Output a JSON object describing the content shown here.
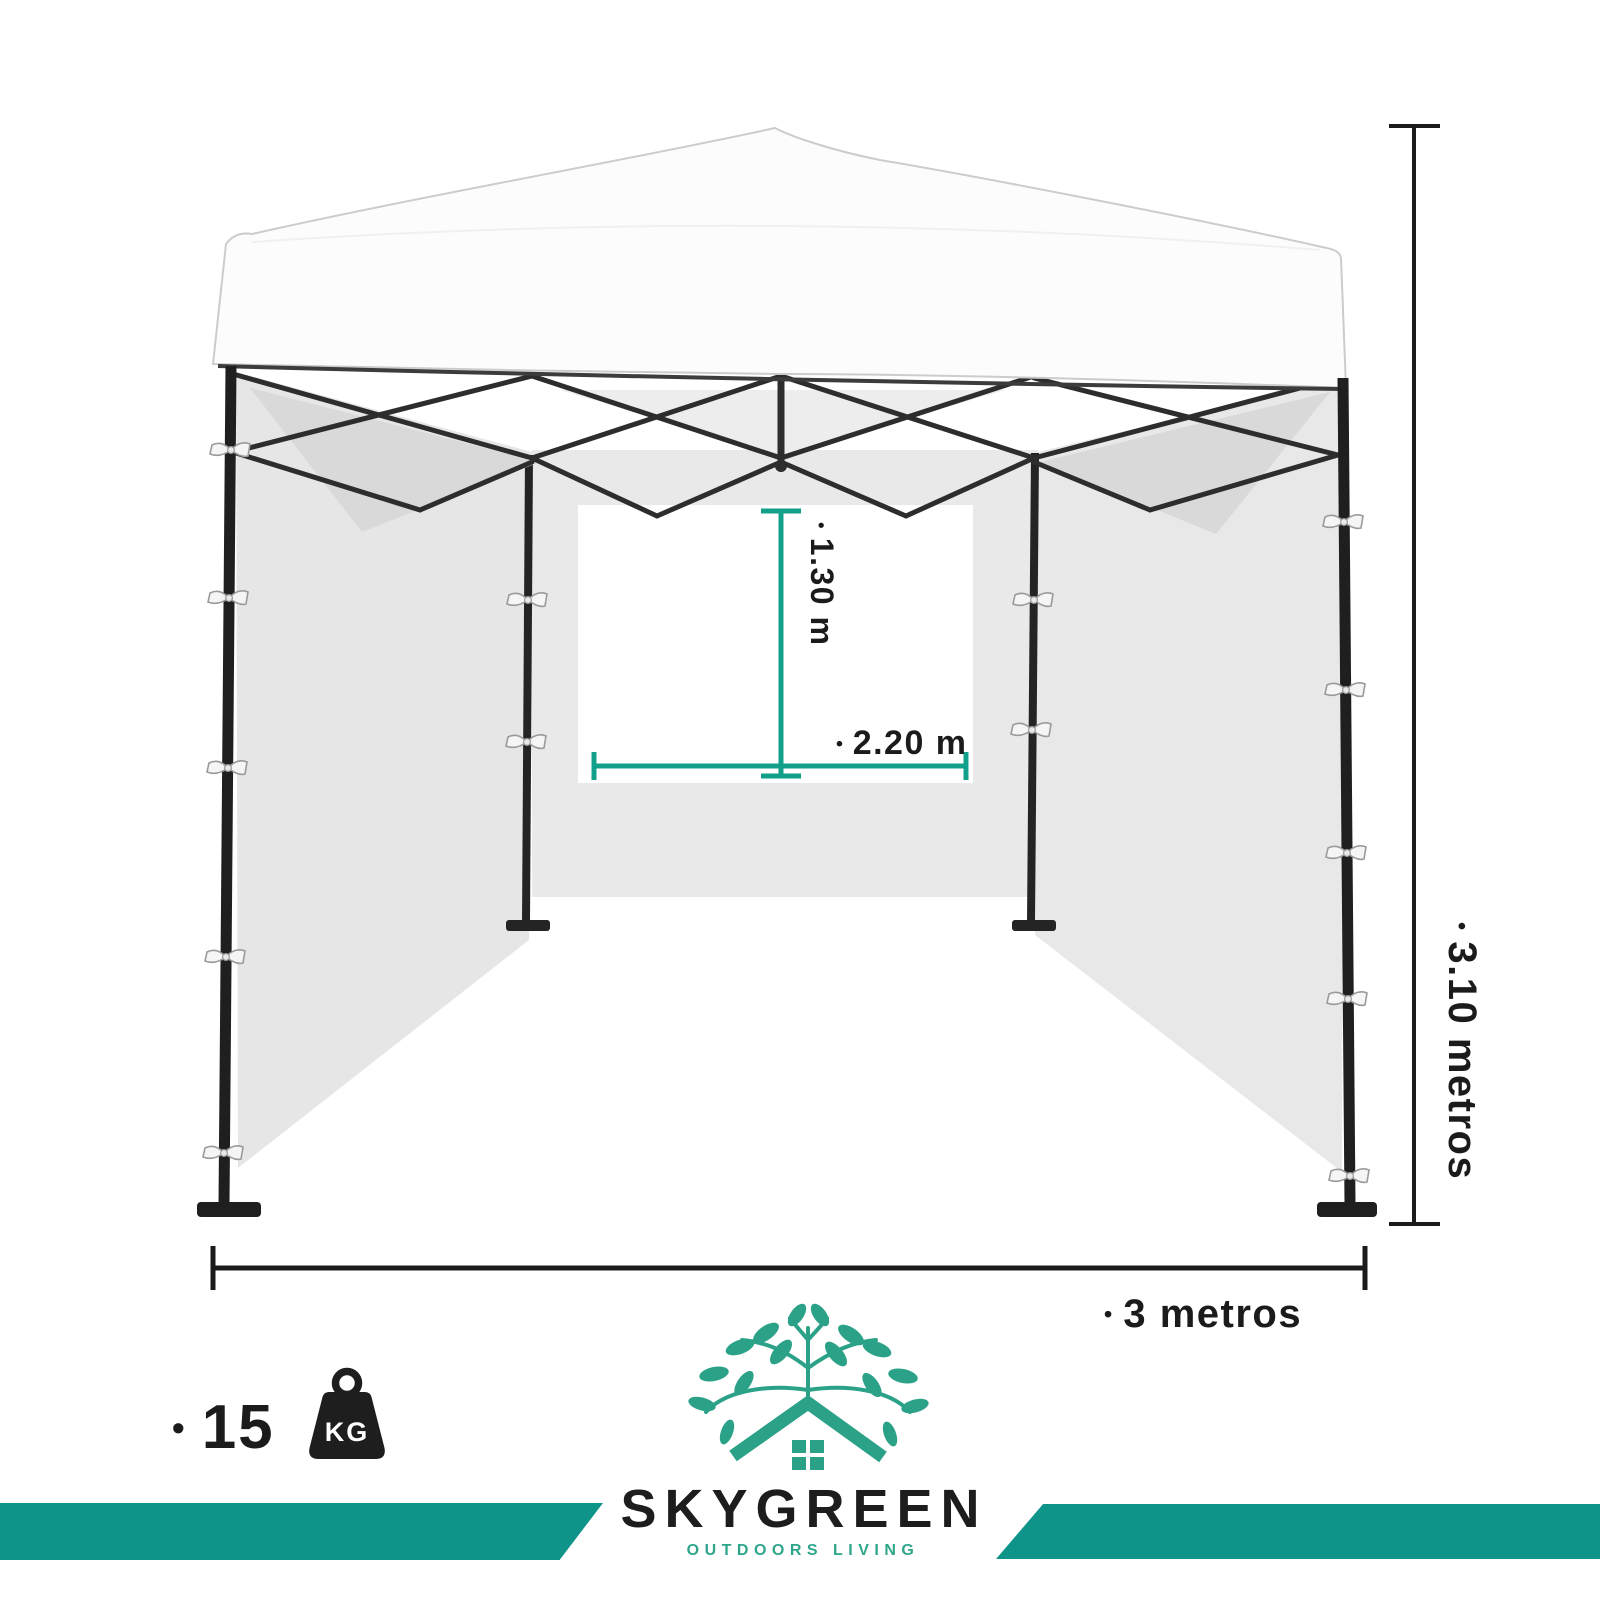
{
  "colors": {
    "accent_teal_bars": "#0E9488",
    "dimension_line_teal": "#12A08B",
    "logo_green": "#2BA287",
    "text_dark": "#1B1B1B"
  },
  "measurements": {
    "bullet": "•",
    "window_height": "1.30 m",
    "window_width": "2.20 m",
    "frame_height": "3.10 metros",
    "frame_width": "3 metros"
  },
  "weight": {
    "bullet": "•",
    "value": "15",
    "unit": "KG",
    "icon": "kettlebell-weight-icon"
  },
  "brand": {
    "name": "SKYGREEN",
    "tagline": "OUTDOORS LIVING",
    "icon": "tree-house-logo-icon"
  },
  "illustration": {
    "subject": "white pop-up canopy tent with side walls and rear window"
  }
}
